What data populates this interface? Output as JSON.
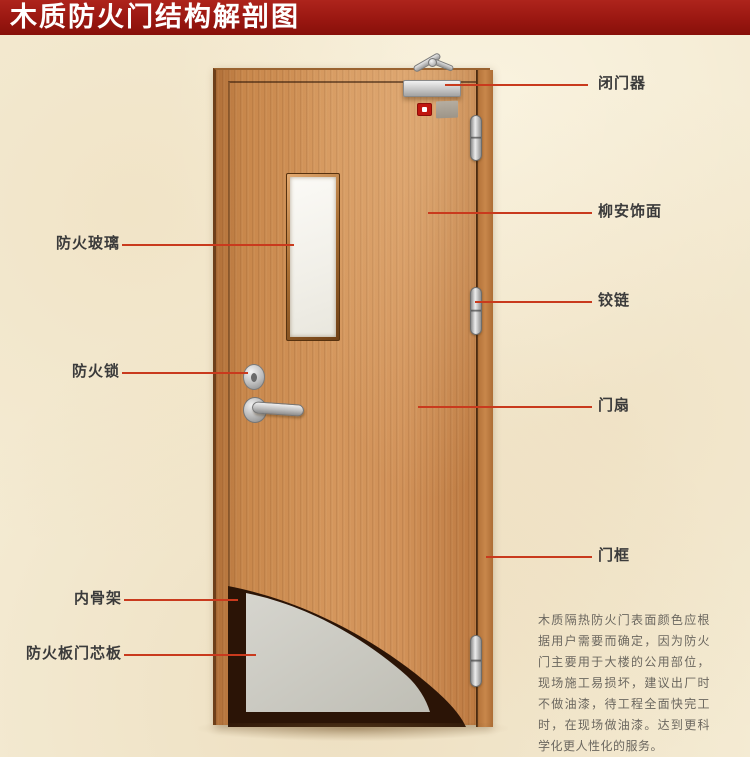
{
  "title": "木质防火门结构解剖图",
  "callouts": {
    "left": [
      {
        "label": "防火玻璃",
        "target": "fire-rated-glass"
      },
      {
        "label": "防火锁",
        "target": "fire-lock"
      },
      {
        "label": "内骨架",
        "target": "inner-skeleton"
      },
      {
        "label": "防火板门芯板",
        "target": "fireproof-core-panel"
      }
    ],
    "right": [
      {
        "label": "闭门器",
        "target": "door-closer"
      },
      {
        "label": "柳安饰面",
        "target": "lauan-veneer"
      },
      {
        "label": "铰链",
        "target": "hinge"
      },
      {
        "label": "门扇",
        "target": "door-leaf"
      },
      {
        "label": "门框",
        "target": "door-frame"
      }
    ]
  },
  "description": "木质隔热防火门表面颜色应根据用户需要而确定，因为防火门主要用于大楼的公用部位，现场施工易损坏，建议出厂时不做油漆，待工程全面快完工时，在现场做油漆。达到更科学化更人性化的服务。",
  "colors": {
    "banner": "#9a1711",
    "leader_line": "#c93a1d",
    "door_wood": "#d0915a",
    "cutaway_edge": "#2b1406",
    "core_panel": "#c9c8c0",
    "background": "#f4ebd3"
  }
}
